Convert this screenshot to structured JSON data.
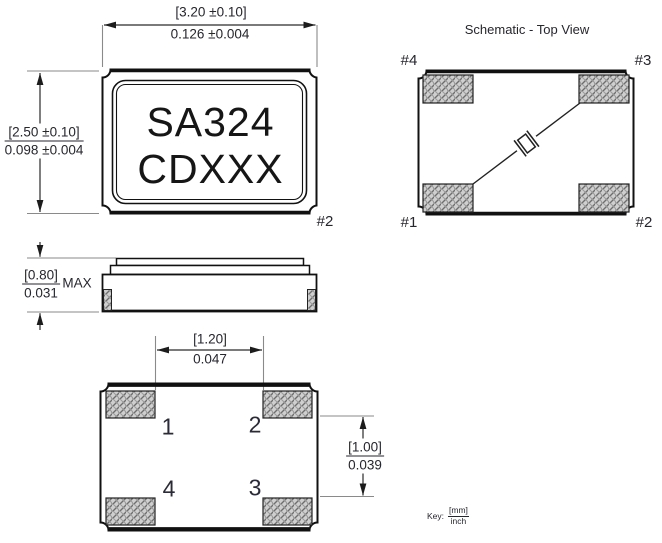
{
  "top_view": {
    "dim_width_mm": "[3.20 ±0.10]",
    "dim_width_inch": "0.126 ±0.004",
    "dim_height_mm": "[2.50 ±0.10]",
    "dim_height_inch": "0.098 ±0.004",
    "marking_line1": "SA324",
    "marking_line2": "CDXXX",
    "pin2_label": "#2"
  },
  "schematic_view": {
    "title": "Schematic - Top View",
    "pin_top_left": "#4",
    "pin_top_right": "#3",
    "pin_bottom_left": "#1",
    "pin_bottom_right": "#2"
  },
  "side_view": {
    "dim_height_mm": "[0.80]",
    "dim_height_inch": "0.031",
    "dim_suffix": "MAX"
  },
  "bottom_view": {
    "dim_pitch_mm": "[1.20]",
    "dim_pitch_inch": "0.047",
    "dim_span_mm": "[1.00]",
    "dim_span_inch": "0.039",
    "pad_top_left": "1",
    "pad_top_right": "2",
    "pad_bottom_left": "4",
    "pad_bottom_right": "3"
  },
  "key": {
    "label": "Key:",
    "numerator": "[mm]",
    "denominator": "inch"
  },
  "colors": {
    "line": "#111111",
    "dim_text": "#26262e",
    "pad_fill": "#cfcfcf",
    "hatch_line": "#6e6e6e"
  }
}
